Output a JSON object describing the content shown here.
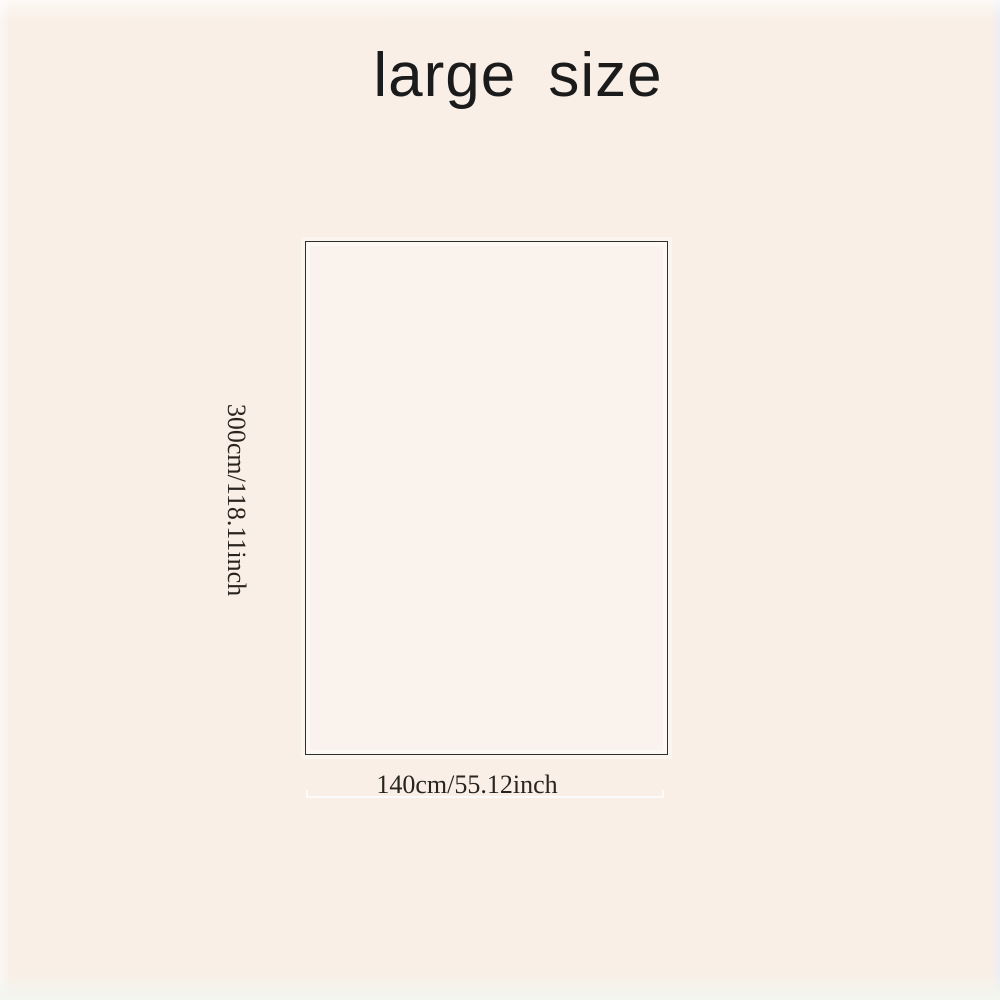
{
  "title": "large size",
  "diagram": {
    "height_label": "300cm/118.11inch",
    "width_label": "140cm/55.12inch"
  },
  "colors": {
    "background": "#f9efe7",
    "rect_border": "#2f2e2c",
    "title_text": "#1b1b1b",
    "label_text": "#2a241f",
    "measure_line": "#ffffff"
  }
}
